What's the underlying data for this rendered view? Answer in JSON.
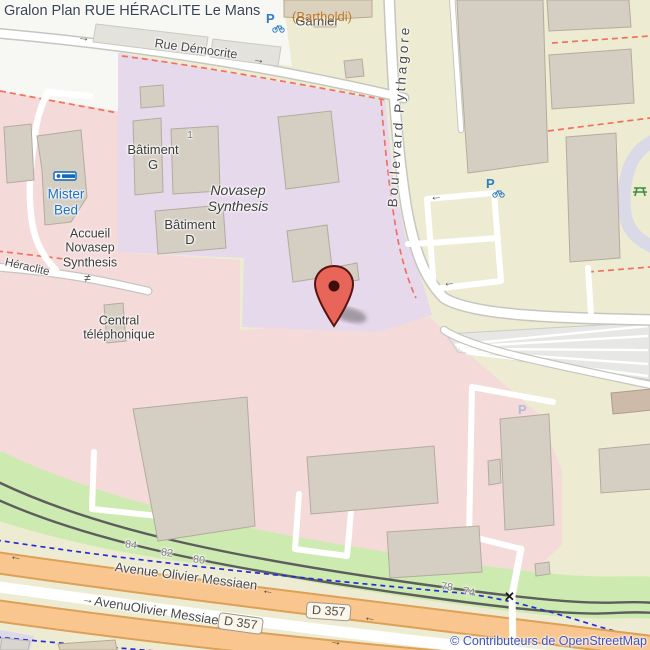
{
  "title": "Gralon Plan RUE HÉRACLITE Le Mans",
  "attribution": "© Contributeurs de OpenStreetMap",
  "streets": {
    "rue_democrite": "Rue Démocrite",
    "boulevard_pythagore": "Boulevard Pythagore",
    "heraclite": "Héraclite",
    "avenue_messiaen_upper": "Avenue Olivier Messiaen",
    "avenue_messiaen_lower": "AvenuOlivier Messiaen",
    "bartholdi": "(Bartholdi)",
    "route_ref": "D 357"
  },
  "places": {
    "garnier": "Garnier",
    "novasep_line1": "Novasep",
    "novasep_line2": "Synthesis",
    "batiment_g_line1": "Bâtiment",
    "batiment_g_line2": "G",
    "batiment_g_number": "1",
    "batiment_d_line1": "Bâtiment",
    "batiment_d_line2": "D",
    "accueil_line1": "Accueil",
    "accueil_line2": "Novasep",
    "accueil_line3": "Synthesis",
    "mister_bed_line1": "Mister",
    "mister_bed_line2": "Bed",
    "central_line1": "Central",
    "central_line2": "téléphonique"
  },
  "house_numbers": [
    "84",
    "82",
    "80",
    "78",
    "74"
  ],
  "icons": {
    "parking_letter": "P",
    "gate": "≠",
    "level_crossing": "✕",
    "oneway_left": "←",
    "oneway_right": "→"
  },
  "colors": {
    "commercial_beige": "#EDECD2",
    "retail_pink": "#F5DADA",
    "industrial_purple": "#E6D9EB",
    "grass_green": "#CDEBB0",
    "road_orange": "#F8C68E",
    "road_orange_casing": "#DCA057",
    "cycleway_blue": "#2B2BD6",
    "boundary_red": "#F2705F",
    "marker_red": "#E8655A",
    "parking_blue": "#2E7CC3",
    "picnic_green": "#3E8E3E",
    "hotel_blue": "#1B6FC8",
    "attribution_blue": "#3B51C7",
    "title_color": "#394453"
  }
}
